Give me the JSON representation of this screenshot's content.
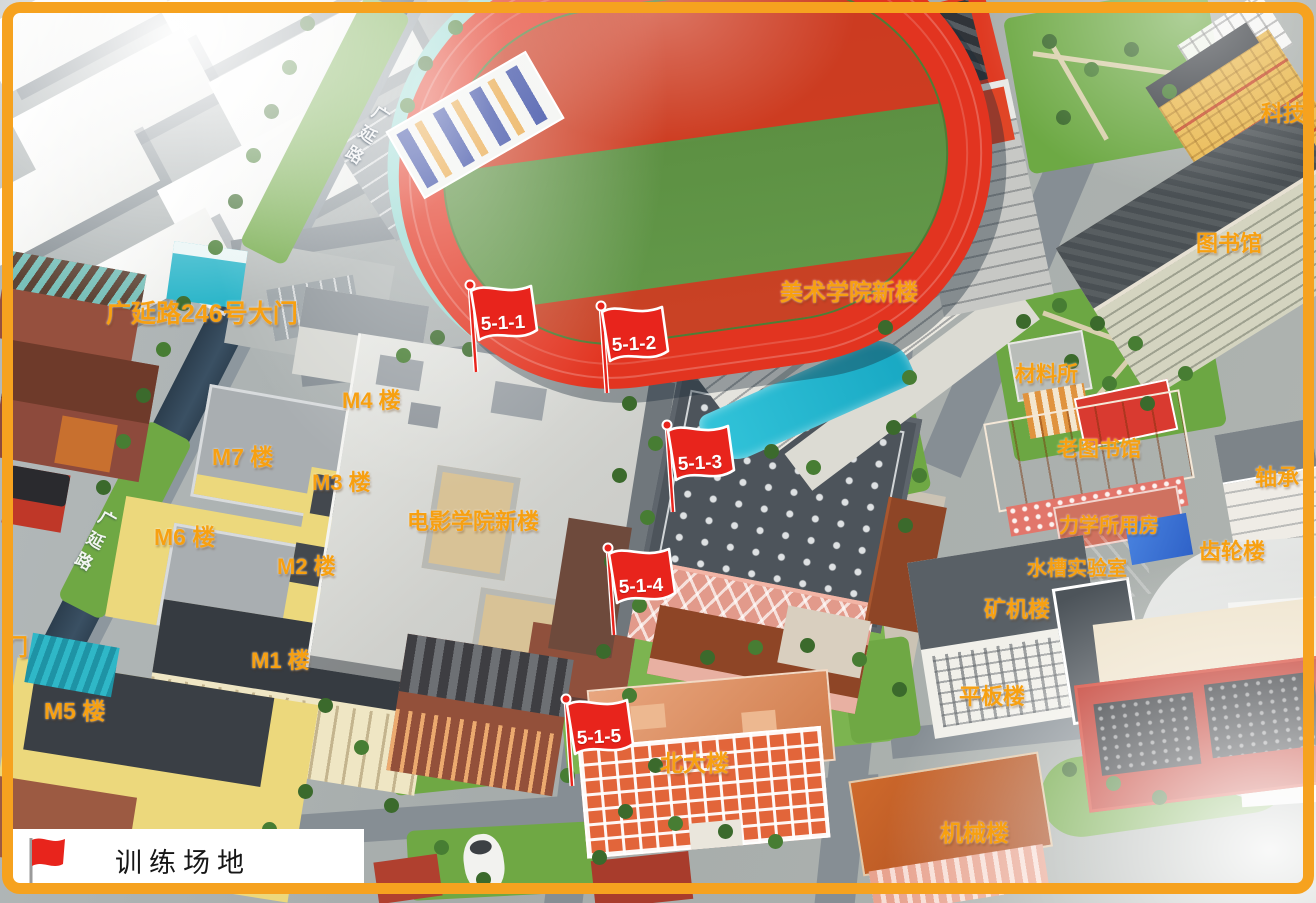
{
  "colors": {
    "frame_orange": "#f6a21f",
    "label_orange": "#f7a011",
    "flag_red": "#e8241c",
    "track_red": "#e23420",
    "field_green": "#5a8d3f",
    "road_dark": "#31455a",
    "legend_bg": "#ffffff",
    "legend_text": "#161616"
  },
  "legend": {
    "label": "训练场地"
  },
  "road_labels": [
    {
      "text": "广延路"
    },
    {
      "text": "广延路"
    }
  ],
  "flags": [
    {
      "label": "5-1-1"
    },
    {
      "label": "5-1-2"
    },
    {
      "label": "5-1-3"
    },
    {
      "label": "5-1-4"
    },
    {
      "label": "5-1-5"
    }
  ],
  "building_labels": [
    {
      "text": "广延路246号大门"
    },
    {
      "text": "M4 楼"
    },
    {
      "text": "M7 楼"
    },
    {
      "text": "M3 楼"
    },
    {
      "text": "M6 楼"
    },
    {
      "text": "M2 楼"
    },
    {
      "text": "电影学院新楼"
    },
    {
      "text": "M1 楼"
    },
    {
      "text": "M5 楼"
    },
    {
      "text": "门"
    },
    {
      "text": "美术学院新楼"
    },
    {
      "text": "图书馆"
    },
    {
      "text": "科技"
    },
    {
      "text": "材料所"
    },
    {
      "text": "老图书馆"
    },
    {
      "text": "轴承"
    },
    {
      "text": "力学所用房"
    },
    {
      "text": "齿轮楼"
    },
    {
      "text": "水槽实验室"
    },
    {
      "text": "矿机楼"
    },
    {
      "text": "平板楼"
    },
    {
      "text": "北大楼"
    },
    {
      "text": "机械楼"
    }
  ]
}
